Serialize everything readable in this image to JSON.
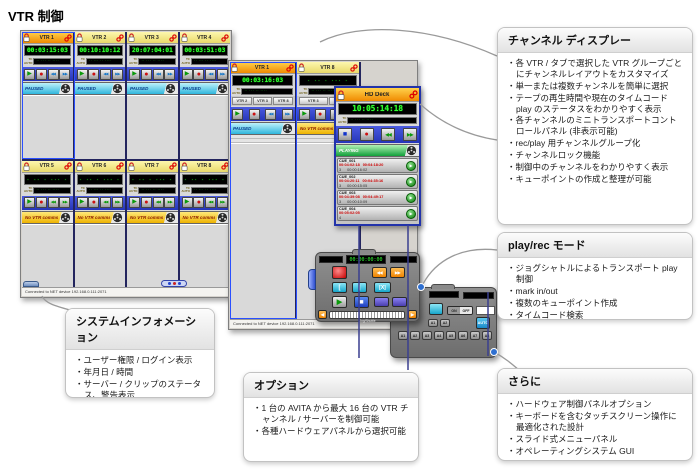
{
  "page": {
    "title": "VTR 制御"
  },
  "labels": {
    "tc": "TC",
    "auto": "AUTO"
  },
  "icons": {
    "play": "▶",
    "record": "●",
    "rewind": "◀◀",
    "fast_forward": "▶▶",
    "stop": "■",
    "arrow_left": "◀",
    "arrow_right": "▶"
  },
  "left_window": {
    "status_bar": "Connected to NET device 192.168.0.111:2071",
    "row1": [
      {
        "name": "VTR 1",
        "timecode": "00:03:15:03",
        "status": "PAUSED",
        "selected": true
      },
      {
        "name": "VTR 2",
        "timecode": "00:10:10:12",
        "status": "PAUSED"
      },
      {
        "name": "VTR 3",
        "timecode": "20:07:04:01",
        "status": "PAUSED"
      },
      {
        "name": "VTR 4",
        "timecode": "00:03:51:03",
        "status": "PAUSED"
      }
    ],
    "row2": [
      {
        "name": "VTR 5",
        "timecode": "",
        "status": "No VTR comms"
      },
      {
        "name": "VTR 6",
        "timecode": "",
        "status": "No VTR comms"
      },
      {
        "name": "VTR 7",
        "timecode": "",
        "status": "No VTR comms"
      },
      {
        "name": "VTR 8",
        "timecode": "",
        "status": "No VTR comms"
      }
    ]
  },
  "center_window": {
    "status_bar": "Connected to NET device 192.168.0.111:2071",
    "channels": [
      {
        "name": "VTR 1",
        "timecode": "00:03:16:03",
        "status": "PAUSED",
        "tabs": [
          "VTR 2",
          "VTR 3",
          "VTR 8"
        ]
      },
      {
        "name": "VTR 8",
        "timecode": "",
        "status": "No VTR comms",
        "tabs": [
          "VTR 3",
          "VTR 6"
        ]
      }
    ],
    "hd_deck": {
      "name": "HD Deck",
      "timecode": "10:05:14:18",
      "status": "PLAYING",
      "cues": [
        {
          "id": "CUE_001",
          "in": "00:04:02:18",
          "out": "00:04:18:20",
          "n": "3",
          "dur": "00:00:16:02"
        },
        {
          "id": "CUE_002",
          "in": "00:04:20:11",
          "out": "00:04:35:16",
          "n": "3",
          "dur": "00:00:15:05"
        },
        {
          "id": "CUE_003",
          "in": "00:04:39:08",
          "out": "00:04:49:17",
          "n": "3",
          "dur": "00:00:10:09"
        },
        {
          "id": "CUE_004",
          "in": "00:05:02:05",
          "out": "",
          "n": "4",
          "dur": ""
        }
      ]
    }
  },
  "transport_panel": {
    "timecode": "00:00:00:00",
    "mark_in": "[",
    "mark_out": "]",
    "mark_clear": "[X]",
    "jog_label": "Jog/Shuttle"
  },
  "aux_panel": {
    "toggle_on": "ON",
    "toggle_off": "OFF",
    "auto_label": "AUTO",
    "pair_buttons": [
      "A1",
      "A2"
    ],
    "channel_buttons": [
      "A1",
      "A2",
      "A3",
      "A4",
      "A5",
      "A6",
      "A7",
      "A8"
    ]
  },
  "callouts": {
    "channel_display": {
      "title": "チャンネル ディスプレー",
      "items": [
        "各 VTR / タブで選択した VTR グループごとにチャンネルレイアウトをカスタマイズ",
        "単一または複数チャンネルを簡単に選択",
        "テープの再生時間や現在のタイムコード play のステータスをわかりやすく表示",
        "各チャンネルのミニトランスポートコントロールパネル (非表示可能)",
        "rec/play 用チャンネルグループ化",
        "チャンネルロック機能",
        "制御中のチャンネルをわかりやすく表示",
        "キューポイントの作成と整理が可能"
      ]
    },
    "play_rec": {
      "title": "play/rec モード",
      "items": [
        "ジョグシャトルによるトランスポート play 制御",
        "mark in/out",
        "複数のキューポイント作成",
        "タイムコード検索",
        "クラッシュレコード",
        "録音時間"
      ]
    },
    "more": {
      "title": "さらに",
      "items": [
        "ハードウェア制御パネルオプション",
        "キーボードを含むタッチスクリーン操作に最適化された設計",
        "スライド式メニューパネル",
        "オペレーティングシステム GUI"
      ]
    },
    "system_info": {
      "title": "システムインフォメーション",
      "items": [
        "ユーザー権限 / ログイン表示",
        "年月日 / 時間",
        "サーバー / クリップのステータス、警告表示"
      ]
    },
    "options": {
      "title": "オプション",
      "items": [
        "1 台の AVITA から最大 16 台の VTR チャンネル / サーバーを制御可能",
        "各種ハードウェアパネルから選択可能"
      ]
    }
  }
}
